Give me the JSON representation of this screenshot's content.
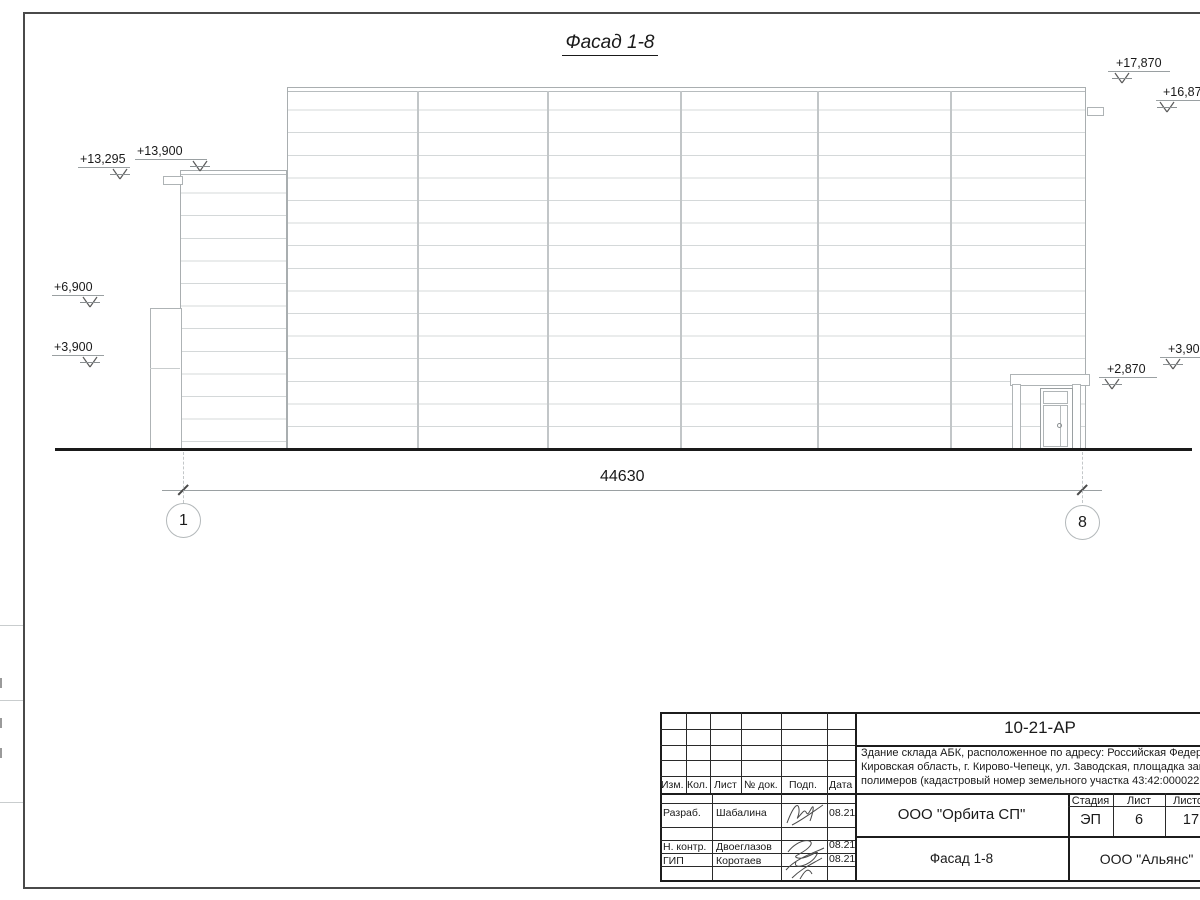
{
  "drawing": {
    "title": "Фасад 1-8",
    "dimension_total": "44630",
    "axis_left": "1",
    "axis_right": "8",
    "elevation_marks": [
      {
        "label": "+13,295",
        "tx": 80,
        "ty": 152,
        "ux": 78,
        "uw": 52,
        "ax": 120
      },
      {
        "label": "+13,900",
        "tx": 137,
        "ty": 144,
        "ux": 135,
        "uw": 72,
        "ax": 200
      },
      {
        "label": "+6,900",
        "tx": 54,
        "ty": 280,
        "ux": 52,
        "uw": 52,
        "ax": 90
      },
      {
        "label": "+3,900",
        "tx": 54,
        "ty": 340,
        "ux": 52,
        "uw": 52,
        "ax": 90
      },
      {
        "label": "+17,870",
        "tx": 1116,
        "ty": 56,
        "ux": 1108,
        "uw": 62,
        "ax": 1122
      },
      {
        "label": "+16,87",
        "tx": 1163,
        "ty": 85,
        "ux": 1156,
        "uw": 44,
        "ax": 1167
      },
      {
        "label": "+3,90",
        "tx": 1168,
        "ty": 342,
        "ux": 1160,
        "uw": 40,
        "ax": 1173
      },
      {
        "label": "+2,870",
        "tx": 1107,
        "ty": 362,
        "ux": 1099,
        "uw": 58,
        "ax": 1112
      }
    ]
  },
  "title_block": {
    "doc_number": "10-21-АР",
    "description_lines": [
      "Здание склада АБК, расположенное по адресу: Российская Федерация,",
      "Кировская область, г. Кирово-Чепецк, ул. Заводская, площадка завода",
      "полимеров (кадастровый номер земельного участка 43:42:000022:3"
    ],
    "header": {
      "izm": "Изм.",
      "kol": "Кол.",
      "list": "Лист",
      "doc": "№ док.",
      "podp": "Подп.",
      "data": "Дата"
    },
    "rows": [
      {
        "role": "Разраб.",
        "name": "Шабалина",
        "date": "08.21"
      },
      {
        "role": "Н. контр.",
        "name": "Двоеглазов",
        "date": "08.21"
      },
      {
        "role": "ГИП",
        "name": "Коротаев",
        "date": "08.21"
      }
    ],
    "org_top": "ООО \"Орбита СП\"",
    "sheet_title": "Фасад 1-8",
    "org_bottom": "ООО \"Альянс\"",
    "stage_header": "Стадия",
    "sheet_header": "Лист",
    "sheets_header": "Листов",
    "stage": "ЭП",
    "sheet": "6",
    "sheets": "17"
  }
}
